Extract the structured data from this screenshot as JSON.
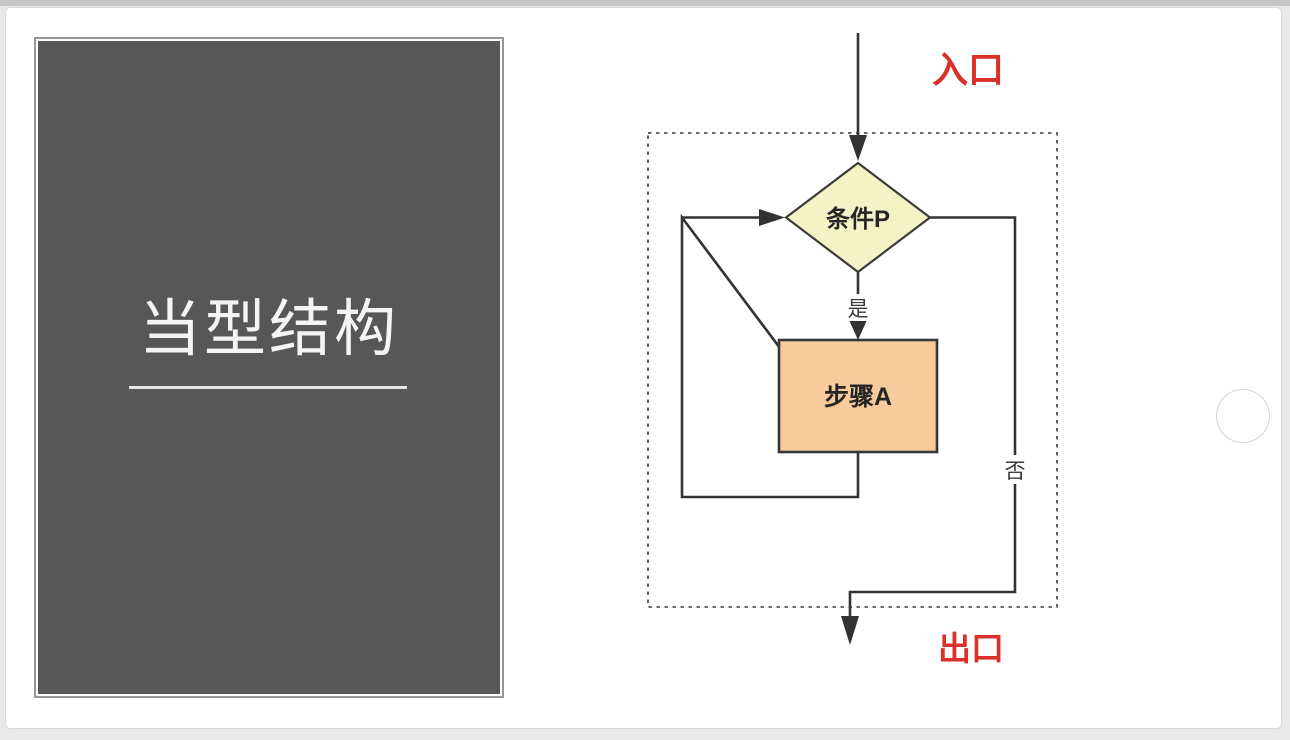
{
  "page": {
    "background": "#e9e9e9",
    "topbar_color": "#c6c6c6"
  },
  "slide": {
    "panel": {
      "title": "当型结构",
      "background": "#575757"
    },
    "flowchart": {
      "entry_label": "入口",
      "exit_label": "出口",
      "condition_label": "条件P",
      "step_label": "步骤A",
      "yes_label": "是",
      "no_label": "否",
      "colors": {
        "label_red": "#d9302a",
        "condition_fill": "#f3f3c6",
        "condition_stroke": "#3b3b3b",
        "step_fill": "#f8cb9c",
        "step_stroke": "#383838",
        "line": "#333333",
        "dashed_border": "#51515c",
        "node_text": "#262626"
      }
    }
  }
}
